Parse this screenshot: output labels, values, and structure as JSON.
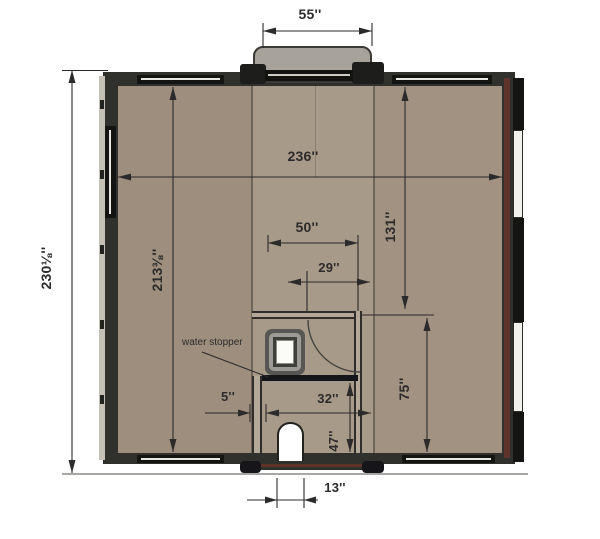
{
  "plan": {
    "type": "floor-plan",
    "annotation": {
      "water_stopper": "water stopper"
    },
    "dimensions": {
      "porch_width": "55''",
      "overall_depth": "230⅛''",
      "interior_depth": "213⅜''",
      "overall_width": "236''",
      "bath_outer_width": "50''",
      "bath_door_offset": "29''",
      "front_wall_to_bath": "131''",
      "threshold_offset": "5''",
      "bath_inner_width": "32''",
      "wet_area_depth": "47''",
      "bath_to_front_wall": "75''",
      "pet_door_width": "13''"
    },
    "colors": {
      "floor_side": "#9d8e7e",
      "floor_center": "#a89a89",
      "wall_dark": "#30302c",
      "wall_maroon": "#5e332c",
      "porch_gray": "#a7a29a",
      "dimension_ink": "#2b2b2b",
      "background": "#ffffff"
    }
  }
}
